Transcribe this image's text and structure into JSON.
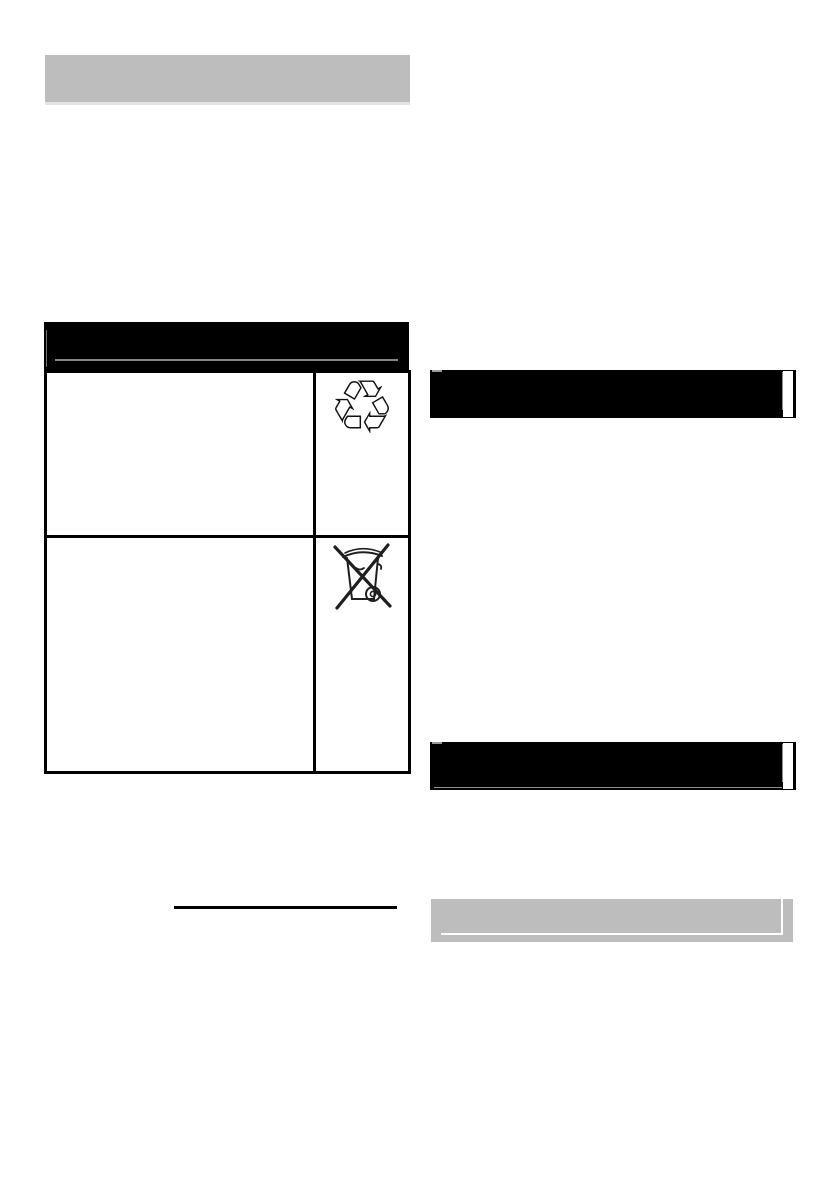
{
  "document": {
    "type": "scanned-manual-page",
    "background": "#ffffff",
    "visible_text": ""
  },
  "palette": {
    "placeholder_gray": "#bdbdbd",
    "heading_black": "#000000",
    "table_border_black": "#000000",
    "inner_rule_gray": "#858585",
    "soft_shadow_gray": "#e4e4e4",
    "icon_stroke": "#1f1f1f"
  },
  "left_column": {
    "top_placeholder_bar": {
      "role": "blank gray section-title bar"
    },
    "symbols_table": {
      "header_bar": {
        "role": "blank black table-header bar with inner gray rule"
      },
      "rows": [
        {
          "description": "",
          "symbol_icon": "recycling-symbol-icon"
        },
        {
          "description": "",
          "symbol_icon": "crossed-out-wheelie-bin-icon"
        }
      ]
    },
    "footnote_rule": {
      "role": "black horizontal underline"
    }
  },
  "right_column": {
    "heading_bars": [
      {
        "role": "blank black heading bar (upper)"
      },
      {
        "role": "blank black heading bar (lower)"
      }
    ],
    "subheading_bar": {
      "role": "blank gray subheading bar with inset bevel"
    }
  },
  "icons": {
    "recycling_glyph": "♲"
  }
}
